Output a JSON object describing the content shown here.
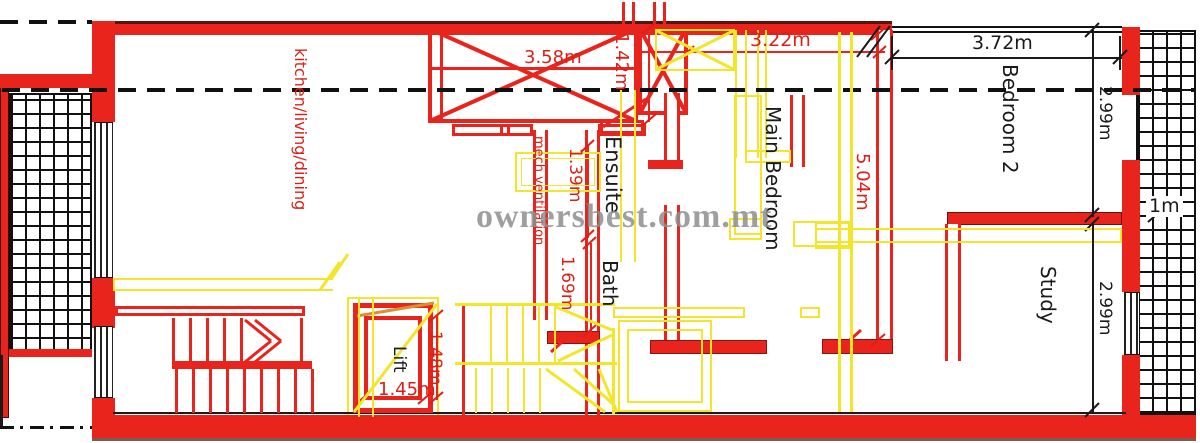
{
  "plan": {
    "watermark": "ownersbest.com.mt",
    "rooms": {
      "kitchen": "kitchen/living/dining",
      "ensuite": "Ensuite",
      "bath": "Bath",
      "main_bedroom": "Main Bedroom",
      "bedroom2": "Bedroom 2",
      "study": "Study",
      "lift": "Lift"
    },
    "dimensions": {
      "d358": "3.58m",
      "d142": "1.42m",
      "d322": "3.22m",
      "d372": "3.72m",
      "d299_top": "2.99m",
      "d1m": "1m",
      "d504": "5.04m",
      "d139": "1.39m",
      "d169": "1.69m",
      "d299_bottom": "2.99m",
      "d148": "1.48m",
      "d145": "1.45m"
    },
    "annotations": {
      "mech_vent": "mech ventilation"
    },
    "colors": {
      "wall_red": "#e8241c",
      "furniture_yellow": "#f3e62a",
      "dimension_red": "#dd1f17",
      "line_black": "#1a1a1a",
      "watermark_gray": "#8f8f8f"
    }
  }
}
